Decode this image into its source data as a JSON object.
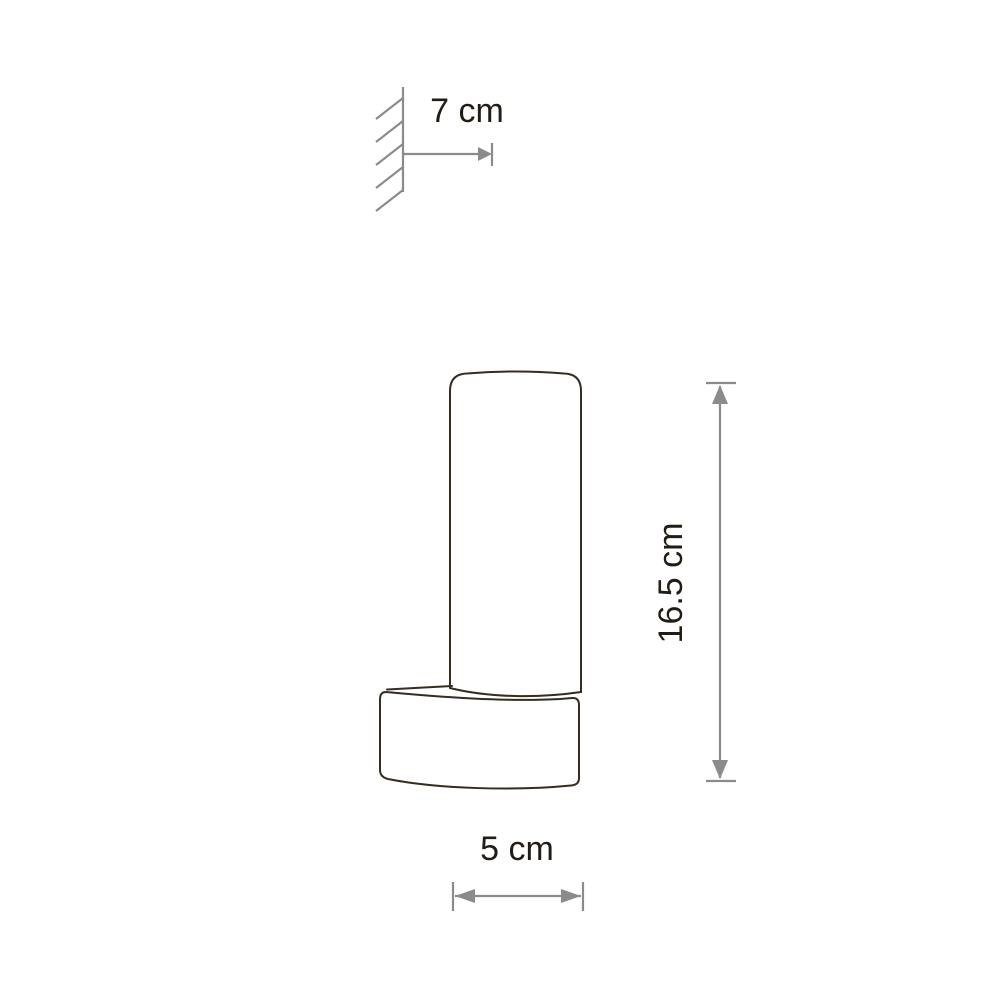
{
  "diagram": {
    "type": "product-dimension-drawing",
    "subject": "wall-mounted-cylinder-lamp",
    "labels": {
      "depth": "7 cm",
      "height": "16.5 cm",
      "width": "5 cm"
    },
    "colors": {
      "background": "#ffffff",
      "outline": "#352c22",
      "dimension": "#8b8b8b",
      "label": "#231c15"
    }
  }
}
